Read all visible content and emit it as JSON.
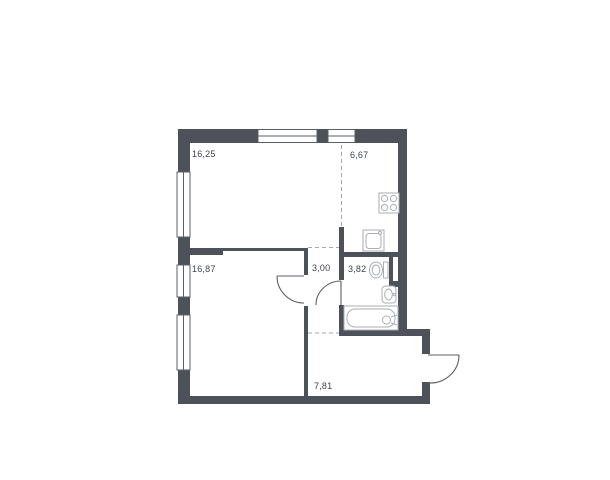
{
  "floorplan": {
    "labels": {
      "living_room": "16,25",
      "kitchen": "6,67",
      "bedroom": "16,87",
      "hallway": "3,00",
      "bathroom": "3,82",
      "corridor": "7,81"
    },
    "icons": [
      "stove-icon",
      "kitchen-sink-icon",
      "toilet-icon",
      "washbasin-icon",
      "bathtub-icon",
      "window-icon",
      "door-swing-icon"
    ],
    "colors": {
      "wall": "#4d525a",
      "thin_line": "#5a5f68",
      "fixture_line": "#a9aeb5",
      "dash_line": "#a3a8b0",
      "label_text": "#3d424a",
      "background": "#ffffff"
    }
  }
}
